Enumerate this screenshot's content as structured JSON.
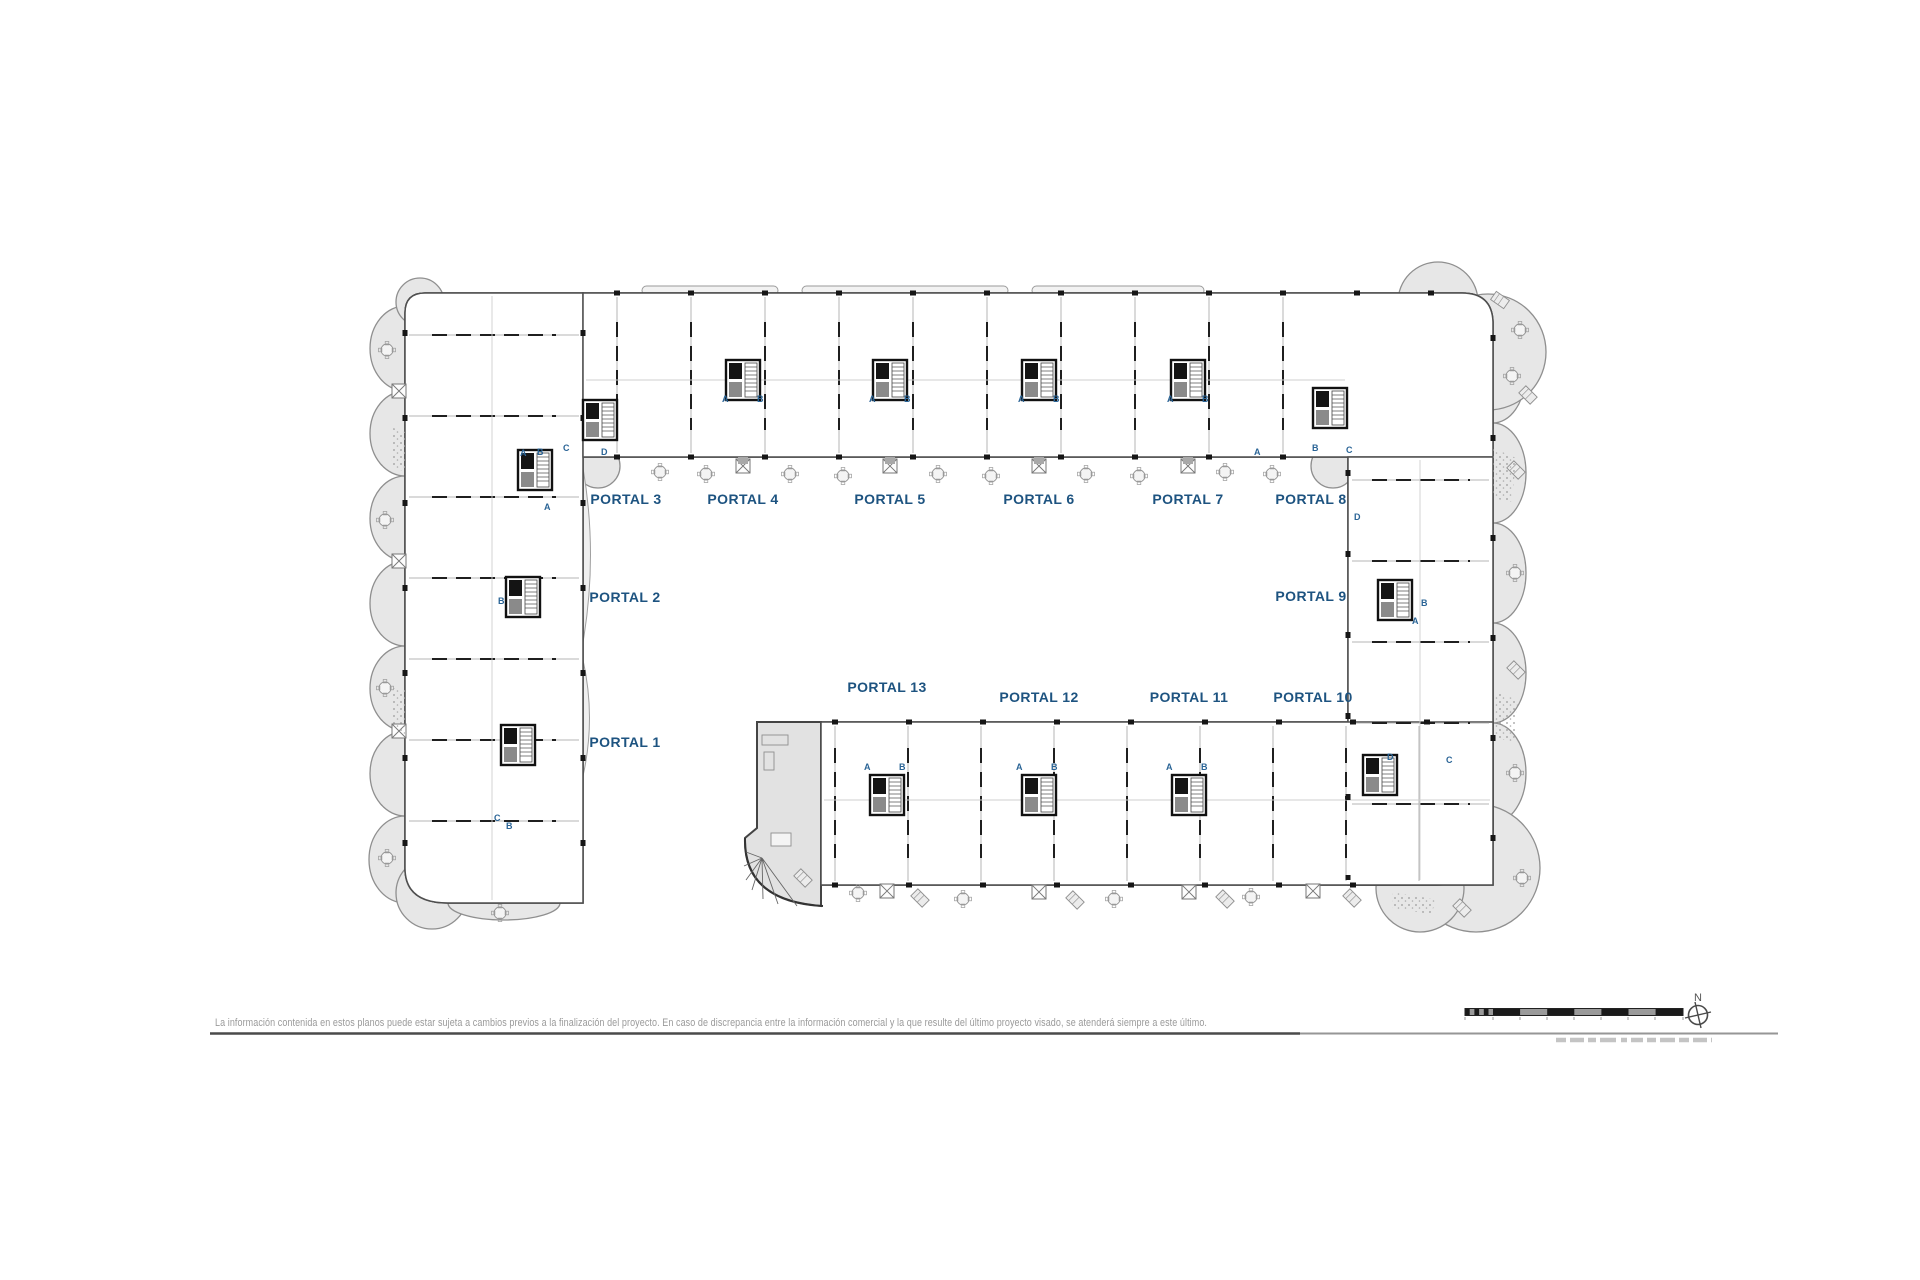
{
  "plan": {
    "colors": {
      "portal_label": "#1d5380",
      "unit_mark": "#2a6496",
      "balcony_fill": "#e7e7e7",
      "terrace_fill": "#e2e2e2",
      "wall_black": "#161616",
      "line_gray": "#8f8f8f"
    },
    "portals": [
      {
        "text": "PORTAL 1"
      },
      {
        "text": "PORTAL 2"
      },
      {
        "text": "PORTAL 3"
      },
      {
        "text": "PORTAL 4"
      },
      {
        "text": "PORTAL 5"
      },
      {
        "text": "PORTAL 6"
      },
      {
        "text": "PORTAL 7"
      },
      {
        "text": "PORTAL 8"
      },
      {
        "text": "PORTAL 9"
      },
      {
        "text": "PORTAL 10"
      },
      {
        "text": "PORTAL 11"
      },
      {
        "text": "PORTAL 12"
      },
      {
        "text": "PORTAL 13"
      }
    ],
    "unit_marks": [
      {
        "t": "A"
      },
      {
        "t": "B"
      },
      {
        "t": "A"
      },
      {
        "t": "B"
      },
      {
        "t": "A"
      },
      {
        "t": "B"
      },
      {
        "t": "A"
      },
      {
        "t": "B"
      },
      {
        "t": "B"
      },
      {
        "t": "C"
      },
      {
        "t": "D"
      },
      {
        "t": "A"
      },
      {
        "t": "A"
      },
      {
        "t": "B"
      },
      {
        "t": "C"
      },
      {
        "t": "D"
      },
      {
        "t": "B"
      },
      {
        "t": "A"
      },
      {
        "t": "D"
      },
      {
        "t": "C"
      },
      {
        "t": "A"
      },
      {
        "t": "B"
      },
      {
        "t": "A"
      },
      {
        "t": "B"
      },
      {
        "t": "A"
      },
      {
        "t": "B"
      },
      {
        "t": "A"
      },
      {
        "t": "B"
      },
      {
        "t": "C"
      },
      {
        "t": "B"
      }
    ]
  },
  "footer": {
    "disclaimer": "La información contenida en estos planos puede estar sujeta a cambios previos a la finalización del proyecto. En caso de discrepancia entre la información comercial y la que resulte del último proyecto visado, se atenderá siempre a este último.",
    "north_label": "N"
  }
}
